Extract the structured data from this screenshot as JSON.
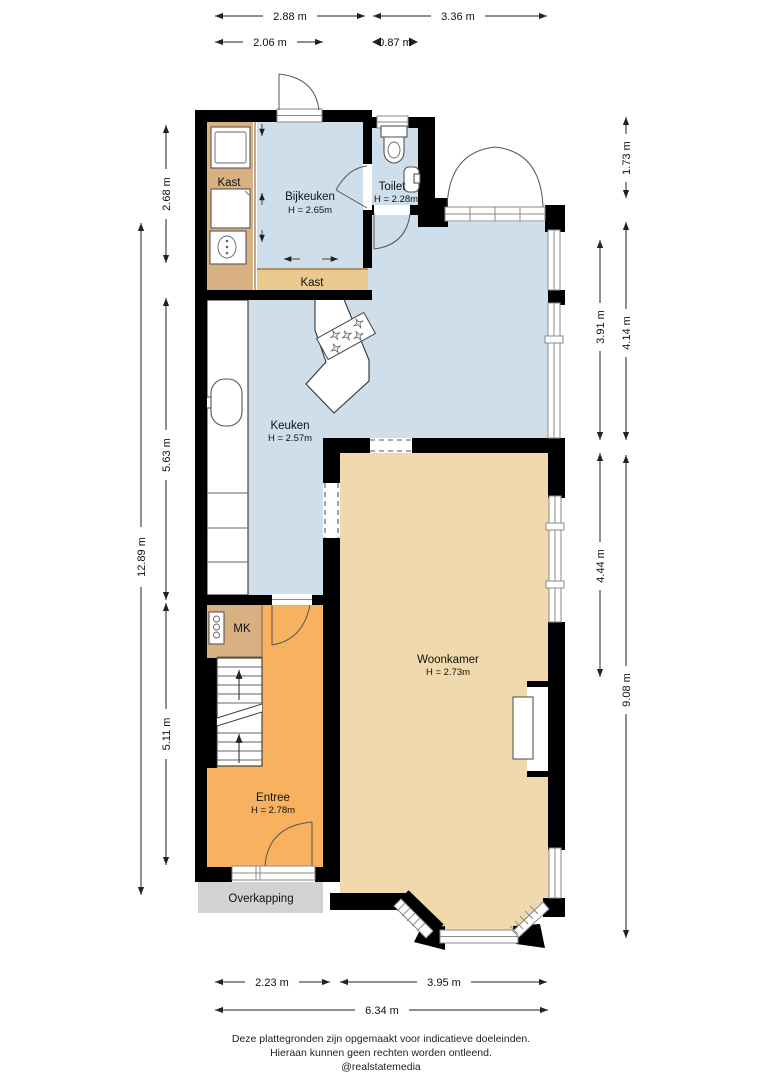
{
  "plan": {
    "rooms": {
      "kast_left": {
        "label": "Kast"
      },
      "bijkeuken": {
        "label": "Bijkeuken",
        "height": "H = 2.65m"
      },
      "toilet": {
        "label": "Toilet",
        "height": "H = 2.28m"
      },
      "kast_bottom": {
        "label": "Kast"
      },
      "keuken": {
        "label": "Keuken",
        "height": "H = 2.57m"
      },
      "mk": {
        "label": "MK"
      },
      "woonkamer": {
        "label": "Woonkamer",
        "height": "H = 2.73m"
      },
      "entree": {
        "label": "Entree",
        "height": "H = 2.78m"
      },
      "overkapping": {
        "label": "Overkapping"
      }
    },
    "colors": {
      "wall": "#000000",
      "utility_blue": "#cfdeeb",
      "living_beige": "#f1d9ae",
      "hall_orange": "#f8b25f",
      "closet_tan": "#d8b183",
      "closet_light_tan": "#eac88e",
      "canopy_gray": "#d2d2d4"
    },
    "fixtures": [
      "washing-machine-icon",
      "cabinet-icon",
      "boiler-icon",
      "toilet-icon",
      "hand-basin-icon",
      "kitchen-sink-icon",
      "gas-hob-icon",
      "stairs-icon",
      "meter-cabinet-icon",
      "fireplace-icon"
    ],
    "dimensions": {
      "top": [
        "2.88 m",
        "3.36 m",
        "2.06 m",
        "0.87 m"
      ],
      "left": [
        "2.68 m",
        "5.63 m",
        "5.11 m",
        "12.89 m"
      ],
      "right": [
        "1.73 m",
        "4.14 m",
        "3.91 m",
        "4.44 m",
        "9.08 m"
      ],
      "bottom": [
        "2.23 m",
        "3.95 m",
        "6.34 m"
      ]
    },
    "footer": {
      "line1": "Deze plattegronden zijn opgemaakt voor indicatieve doeleinden.",
      "line2": "Hieraan kunnen geen rechten worden ontleend.",
      "line3": "@realstatemedia"
    }
  }
}
